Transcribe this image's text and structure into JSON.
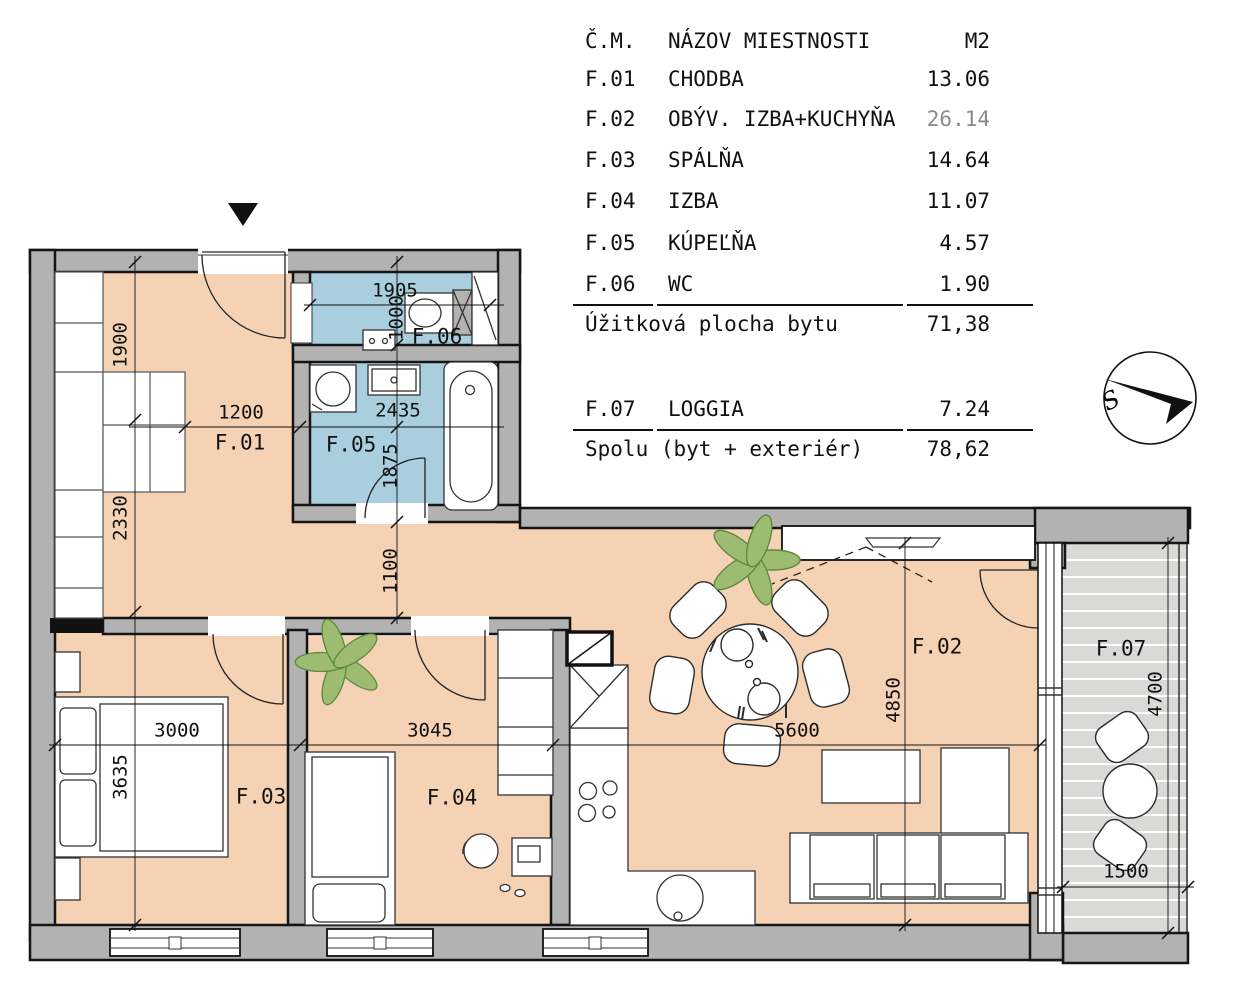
{
  "colors": {
    "floor": "#f5d2b4",
    "wet_floor": "#a9cede",
    "wall": "#b2b2b2",
    "loggia_floor": "#d9d9d7",
    "plant": "#9dbc72",
    "line": "#1a1a1a",
    "muted_value": "#8a8a8a"
  },
  "legend_table": {
    "header": {
      "number": "Č.M.",
      "name": "NÁZOV MIESTNOSTI",
      "area": "M2"
    },
    "rows": [
      {
        "number": "F.01",
        "name": "CHODBA",
        "area": "13.06"
      },
      {
        "number": "F.02",
        "name": "OBÝV. IZBA+KUCHYŇA",
        "area": "26.14"
      },
      {
        "number": "F.03",
        "name": "SPÁLŇA",
        "area": "14.64"
      },
      {
        "number": "F.04",
        "name": "IZBA",
        "area": "11.07"
      },
      {
        "number": "F.05",
        "name": "KÚPEĽŇA",
        "area": "4.57"
      },
      {
        "number": "F.06",
        "name": "WC",
        "area": "1.90"
      }
    ],
    "subtotal": {
      "label": "Úžitková plocha bytu",
      "value": "71,38"
    },
    "loggia_row": {
      "number": "F.07",
      "name": "LOGGIA",
      "area": "7.24"
    },
    "total": {
      "label": "Spolu (byt + exteriér)",
      "value": "78,62"
    }
  },
  "plan": {
    "rooms": {
      "f01": "F.01",
      "f02": "F.02",
      "f03": "F.03",
      "f04": "F.04",
      "f05": "F.05",
      "f06": "F.06",
      "f07": "F.07"
    },
    "dims": {
      "d1900": "1900",
      "d2330": "2330",
      "d3635": "3635",
      "d1200": "1200",
      "d1905": "1905",
      "d1000": "1000",
      "d2435": "2435",
      "d1875": "1875",
      "d1100": "1100",
      "d3000": "3000",
      "d3045": "3045",
      "d5600": "5600",
      "d4850": "4850",
      "d4700": "4700",
      "d1500": "1500"
    },
    "compass": {
      "letter": "S"
    }
  }
}
